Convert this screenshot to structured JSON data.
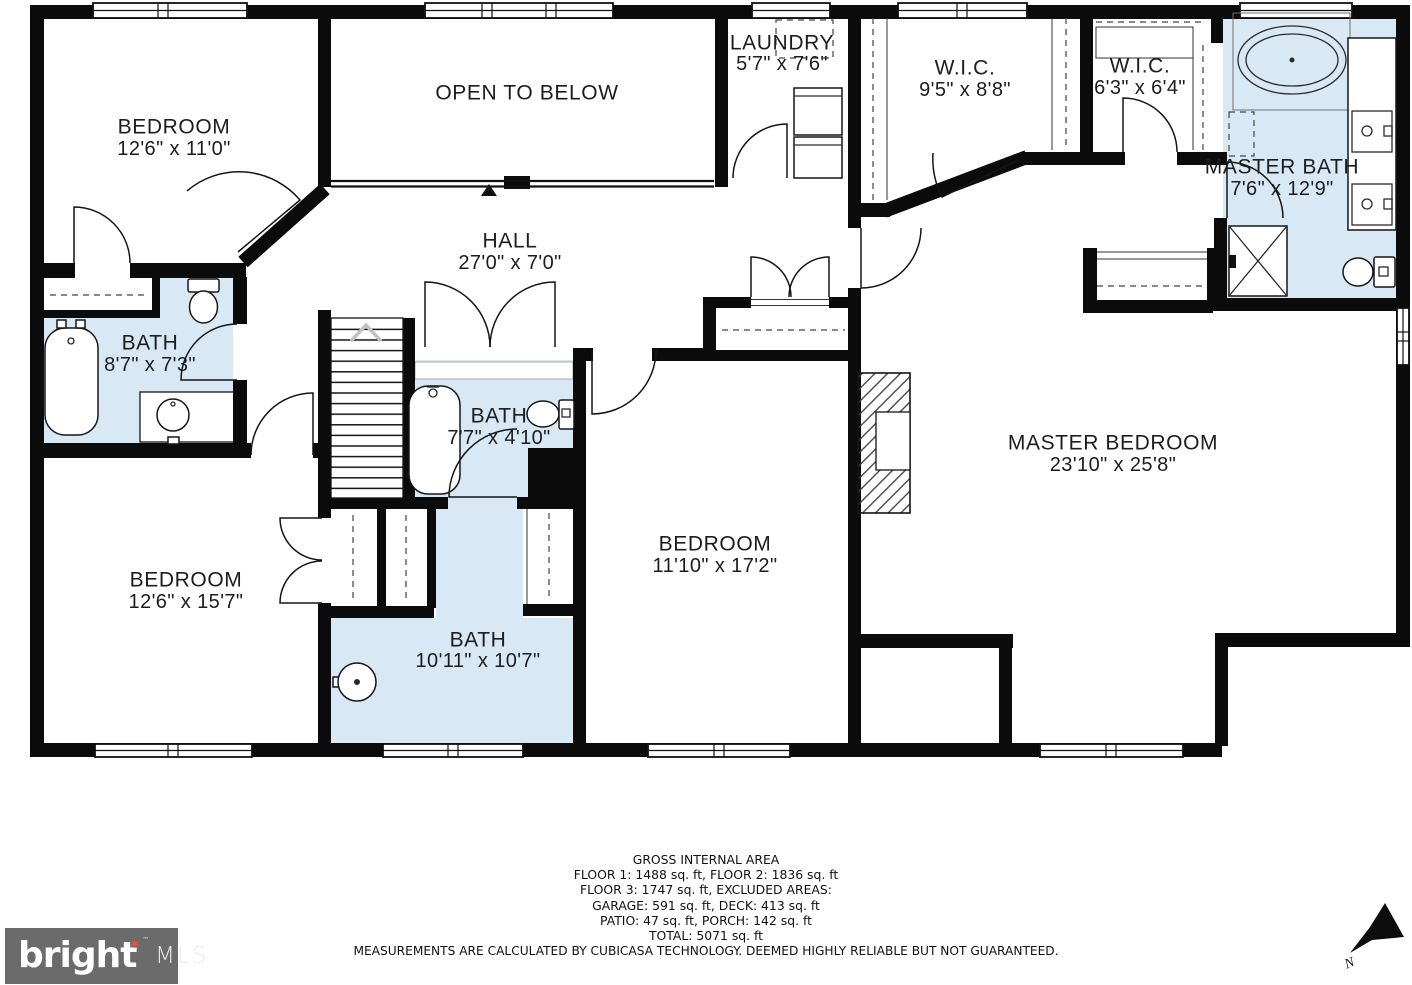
{
  "title": "Floor plan – Floor 2",
  "rooms": [
    {
      "name": "BEDROOM",
      "dims": "12'6\" x 11'0\"",
      "x": 174,
      "y": 127,
      "y2": 149
    },
    {
      "name": "OPEN TO BELOW",
      "dims": "",
      "x": 527,
      "y": 93,
      "y2": 0
    },
    {
      "name": "LAUNDRY",
      "dims": "5'7\" x 7'6\"",
      "x": 782,
      "y": 43,
      "y2": 64
    },
    {
      "name": "W.I.C.",
      "dims": "9'5\" x 8'8\"",
      "x": 965,
      "y": 68,
      "y2": 90
    },
    {
      "name": "W.I.C.",
      "dims": "6'3\" x 6'4\"",
      "x": 1140,
      "y": 66,
      "y2": 88
    },
    {
      "name": "MASTER BATH",
      "dims": "7'6\" x 12'9\"",
      "x": 1282,
      "y": 167,
      "y2": 189
    },
    {
      "name": "HALL",
      "dims": "27'0\" x 7'0\"",
      "x": 510,
      "y": 241,
      "y2": 263
    },
    {
      "name": "BATH",
      "dims": "8'7\" x 7'3\"",
      "x": 150,
      "y": 343,
      "y2": 365
    },
    {
      "name": "BATH",
      "dims": "7'7\" x 4'10\"",
      "x": 499,
      "y": 416,
      "y2": 438
    },
    {
      "name": "MASTER BEDROOM",
      "dims": "23'10\" x 25'8\"",
      "x": 1113,
      "y": 443,
      "y2": 465
    },
    {
      "name": "BEDROOM",
      "dims": "11'10\" x 17'2\"",
      "x": 715,
      "y": 544,
      "y2": 566
    },
    {
      "name": "BEDROOM",
      "dims": "12'6\" x 15'7\"",
      "x": 186,
      "y": 580,
      "y2": 602
    },
    {
      "name": "BATH",
      "dims": "10'11\" x 10'7\"",
      "x": 478,
      "y": 640,
      "y2": 661
    }
  ],
  "footer": {
    "lines": [
      "GROSS INTERNAL AREA",
      "FLOOR 1: 1488 sq. ft, FLOOR 2: 1836 sq. ft",
      "FLOOR 3: 1747 sq. ft, EXCLUDED AREAS:",
      "GARAGE: 591 sq. ft, DECK: 413 sq. ft",
      "PATIO: 47 sq. ft, PORCH: 142 sq. ft",
      "TOTAL: 5071 sq. ft"
    ],
    "disclaimer": "MEASUREMENTS ARE CALCULATED BY CUBICASA TECHNOLOGY. DEEMED HIGHLY RELIABLE BUT NOT GUARANTEED."
  },
  "logo": {
    "brand": "bright",
    "star": "✶",
    "tm": "™",
    "suffix": "MLS"
  },
  "compass": {
    "label": "N"
  },
  "colors": {
    "bath_fill": "#d8e9f5",
    "wall": "#0b0b0b",
    "logo_bg": "#6b6b6b",
    "logo_star": "#e8553e",
    "label": "#1d1d1d"
  }
}
